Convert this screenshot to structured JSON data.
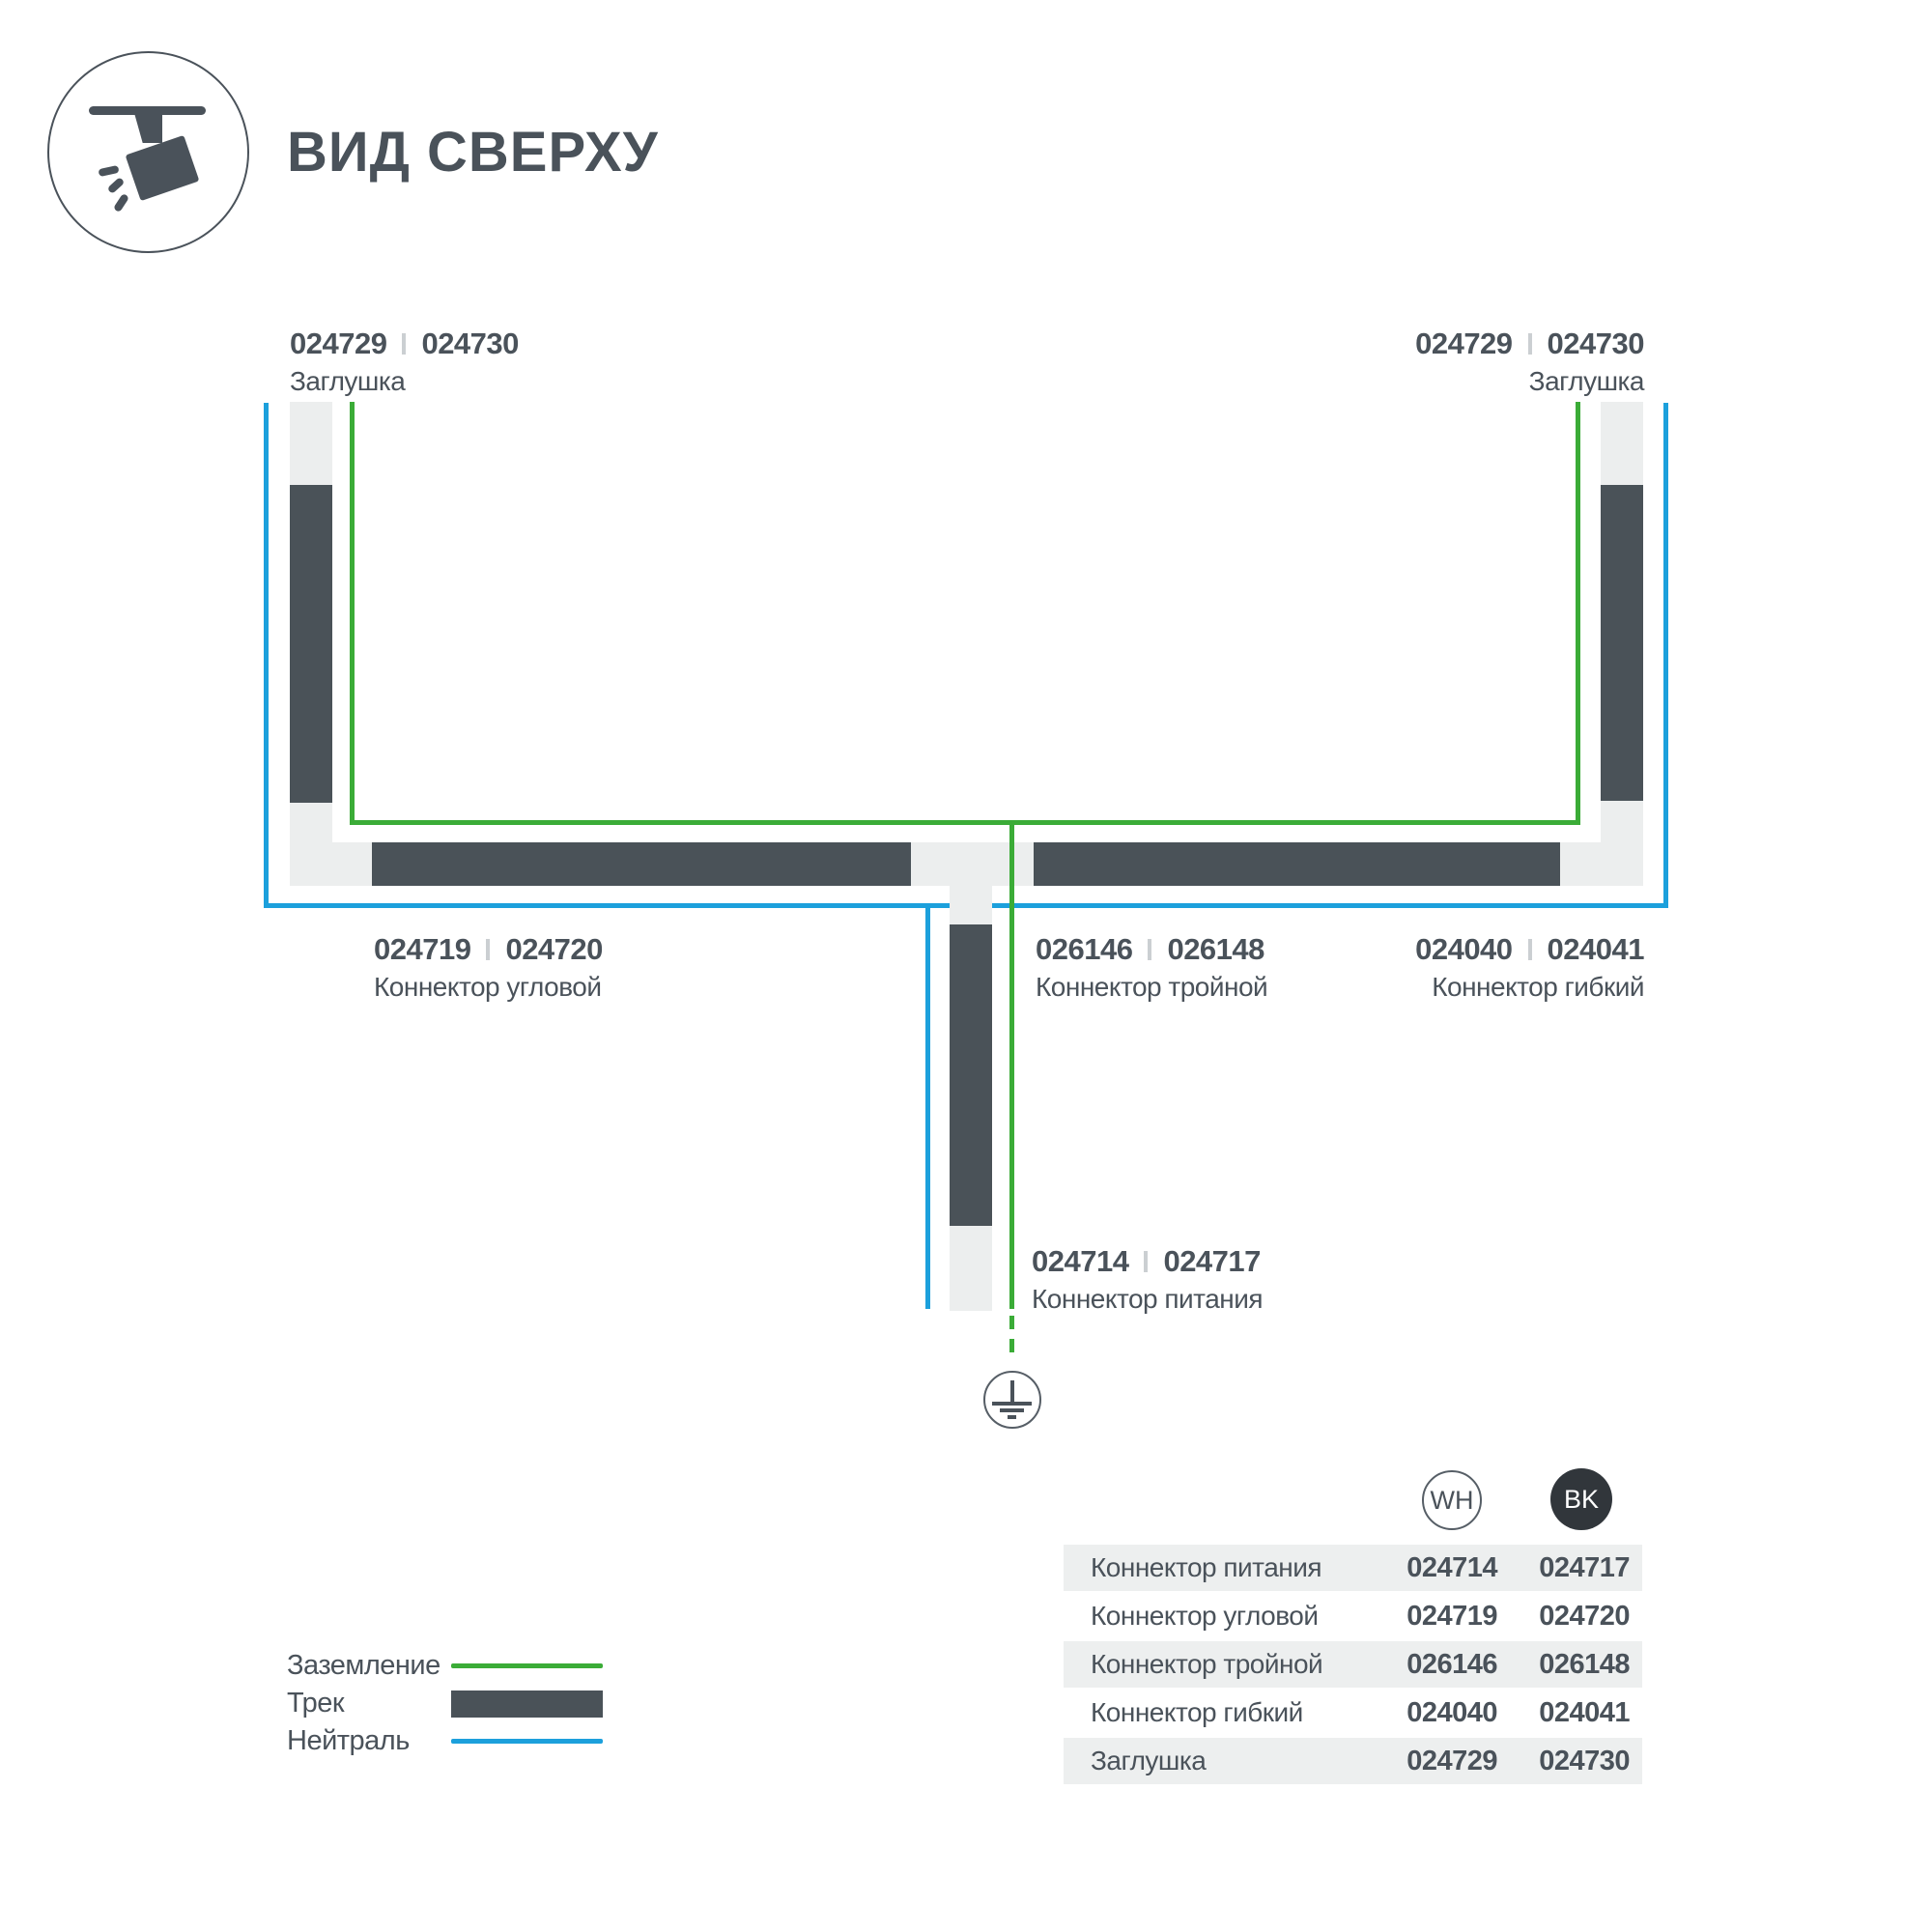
{
  "title": "ВИД СВЕРХУ",
  "colors": {
    "track": "#4A5258",
    "connector": "#ECEEEE",
    "ground_line": "#3BAC37",
    "neutral_line": "#1CA0DC",
    "text": "#4A525A",
    "table_row_bg": "#EDEFEF",
    "bk_circle": "#31363B"
  },
  "diagram": {
    "labels": {
      "cap_left": {
        "code_wh": "024729",
        "code_bk": "024730",
        "name": "Заглушка"
      },
      "cap_right": {
        "code_wh": "024729",
        "code_bk": "024730",
        "name": "Заглушка"
      },
      "corner": {
        "code_wh": "024719",
        "code_bk": "024720",
        "name": "Коннектор угловой"
      },
      "triple": {
        "code_wh": "026146",
        "code_bk": "026148",
        "name": "Коннектор тройной"
      },
      "flexible": {
        "code_wh": "024040",
        "code_bk": "024041",
        "name": "Коннектор гибкий"
      },
      "power": {
        "code_wh": "024714",
        "code_bk": "024717",
        "name": "Коннектор питания"
      }
    }
  },
  "legend": {
    "ground_label": "Заземление",
    "track_label": "Трек",
    "neutral_label": "Нейтраль"
  },
  "table": {
    "col_wh": "WH",
    "col_bk": "BK",
    "rows": [
      {
        "label": "Коннектор питания",
        "wh": "024714",
        "bk": "024717"
      },
      {
        "label": "Коннектор угловой",
        "wh": "024719",
        "bk": "024720"
      },
      {
        "label": "Коннектор тройной",
        "wh": "026146",
        "bk": "026148"
      },
      {
        "label": "Коннектор гибкий",
        "wh": "024040",
        "bk": "024041"
      },
      {
        "label": "Заглушка",
        "wh": "024729",
        "bk": "024730"
      }
    ]
  }
}
